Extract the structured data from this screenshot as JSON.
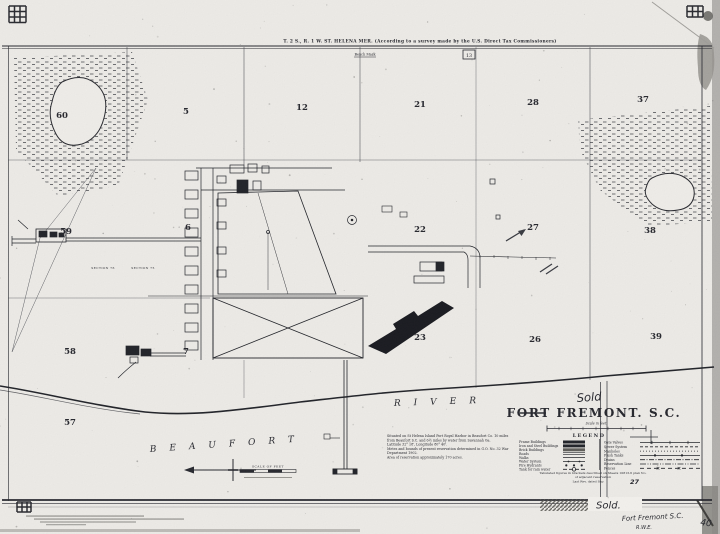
{
  "map": {
    "header": {
      "township_line": "T. 2 S., R. 1 W.  ST. HELENA MER. (According to a survey made by the U.S. Direct Tax Commissioners)",
      "bench_mark": "Bench Mark",
      "marker_13": "13"
    },
    "title_block": {
      "sold_note": "Sold",
      "title": "FORT FREMONT. S.C.",
      "scale_caption": "Scale in feet"
    },
    "water": {
      "name_left": "BEAUFORT",
      "name_right": "RIVER"
    },
    "section_numbers": [
      {
        "label": "60",
        "x": 62,
        "y": 118
      },
      {
        "label": "5",
        "x": 186,
        "y": 114
      },
      {
        "label": "12",
        "x": 302,
        "y": 110
      },
      {
        "label": "21",
        "x": 420,
        "y": 107
      },
      {
        "label": "28",
        "x": 533,
        "y": 105
      },
      {
        "label": "37",
        "x": 643,
        "y": 102
      },
      {
        "label": "59",
        "x": 66,
        "y": 234
      },
      {
        "label": "6",
        "x": 188,
        "y": 230
      },
      {
        "label": "22",
        "x": 420,
        "y": 232
      },
      {
        "label": "27",
        "x": 533,
        "y": 230
      },
      {
        "label": "38",
        "x": 650,
        "y": 233
      },
      {
        "label": "58",
        "x": 70,
        "y": 354
      },
      {
        "label": "7",
        "x": 186,
        "y": 354
      },
      {
        "label": "23",
        "x": 420,
        "y": 340
      },
      {
        "label": "26",
        "x": 535,
        "y": 342
      },
      {
        "label": "39",
        "x": 656,
        "y": 339
      },
      {
        "label": "57",
        "x": 70,
        "y": 425
      }
    ],
    "small_labels": [
      {
        "label": "SECTION 76",
        "x": 103,
        "y": 269
      },
      {
        "label": "SECTION 75",
        "x": 143,
        "y": 269
      }
    ],
    "notes": {
      "lines": [
        "Situated on St Helena Island Port Royal Harbor in Beaufort Co. 10 miles",
        "from Beaufort S.C. and 6½ miles by water from Savannah Ga.",
        "Latitude 32° 18', Longitude 80° 40'.",
        "Metes and bounds of present reservation determined in G.O. No. 32 War",
        "Department 1902.",
        "Area of reservation approximately 170 acres."
      ]
    },
    "legend": {
      "title": "LEGEND",
      "left": [
        {
          "label": "Frame Buildings",
          "swatch": "solid-bar"
        },
        {
          "label": "Iron and Steel Buildings",
          "swatch": "solid-bar"
        },
        {
          "label": "Brick Buildings",
          "swatch": "gray-bar"
        },
        {
          "label": "Roads",
          "swatch": "double-line"
        },
        {
          "label": "Walks",
          "swatch": "single-line"
        },
        {
          "label": "Water System",
          "swatch": "line-dots"
        },
        {
          "label": "Fire Hydrants",
          "swatch": "dots"
        },
        {
          "label": "Tank for rain water",
          "swatch": "circle"
        }
      ],
      "right": [
        {
          "label": "Gate Valves",
          "swatch": "tick-line"
        },
        {
          "label": "Sewer System",
          "swatch": "dashed"
        },
        {
          "label": "Manholes",
          "swatch": "dot-line"
        },
        {
          "label": "Flush Tanks",
          "swatch": "square-line"
        },
        {
          "label": "Drains",
          "swatch": "dashdot"
        },
        {
          "label": "Reservation Line",
          "swatch": "dashdotdot"
        },
        {
          "label": "Fences",
          "swatch": "cross-line"
        }
      ]
    },
    "attribution": {
      "line1": "Tabulated figures in brackets described on Sheets 10813-6 plan No.",
      "line2": "of adjacent reservation",
      "line3": "Last Rev. dated Sep",
      "revision_number": "27"
    },
    "compass_scale": {
      "scale_of_feet": "SCALE OF FEET"
    },
    "margin": {
      "sold_note": "Sold.",
      "handwritten_title": "Fort Fremont S.C.",
      "initials": "R.W.E.",
      "number": "40"
    }
  }
}
